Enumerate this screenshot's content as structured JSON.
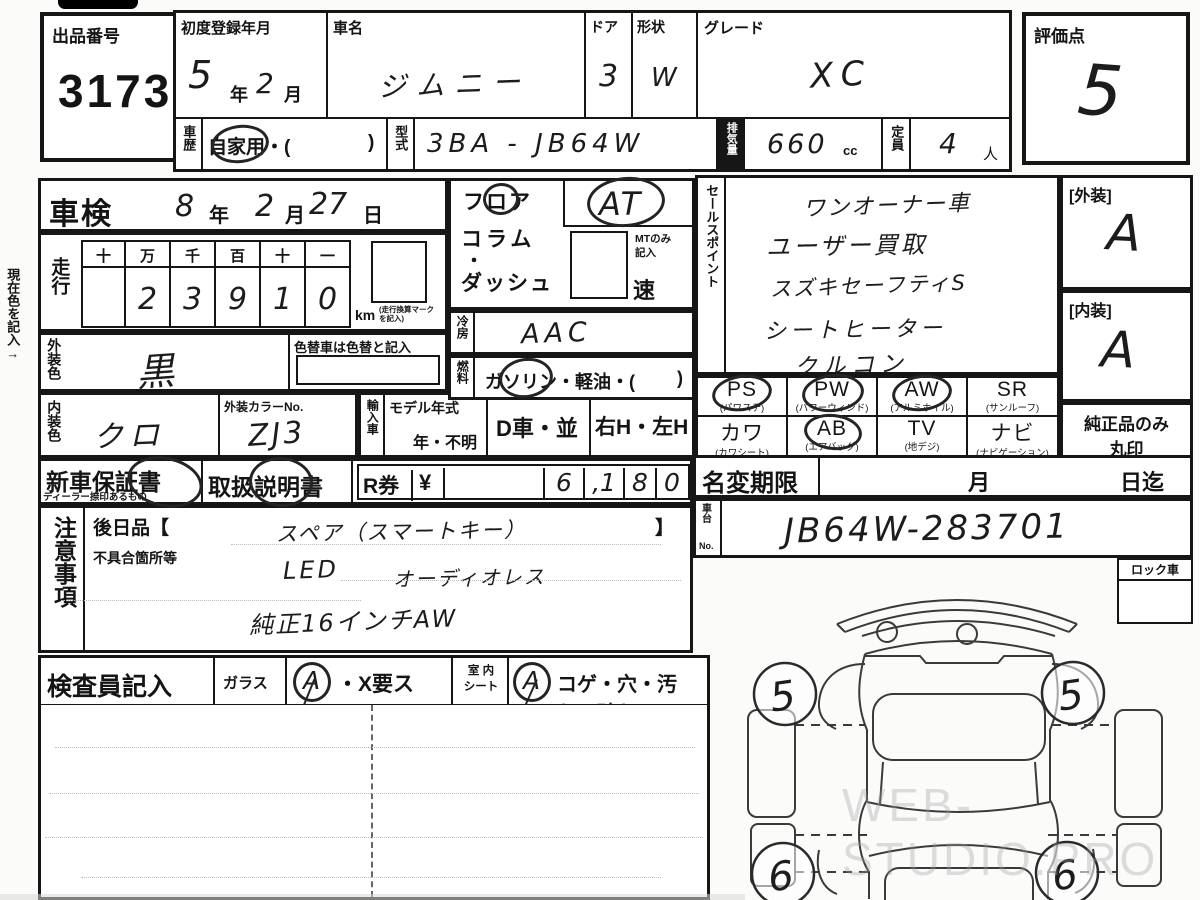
{
  "watermark": "WEB-STUDIO.PRO",
  "margin_note": "現在色を記入→",
  "header": {
    "lot_label": "出品番号",
    "lot_value": "3173",
    "first_reg_label": "初度登録年月",
    "first_reg_year": "5",
    "year_unit": "年",
    "first_reg_month": "2",
    "month_unit": "月",
    "car_name_label": "車名",
    "car_name_value": "ジムニー",
    "door_label": "ドア",
    "door_value": "3",
    "shape_label": "形状",
    "shape_value": "W",
    "grade_label": "グレード",
    "grade_value": "XC",
    "history_label": "車歴",
    "history_value": "自家用・(",
    "history_close": ")",
    "model_code_label": "型式",
    "model_code_value": "3BA - JB64W",
    "displacement_label": "排気量",
    "displacement_value": "660",
    "displacement_unit": "cc",
    "capacity_label": "定員",
    "capacity_value": "4",
    "capacity_unit": "人",
    "score_label": "評価点",
    "score_value": "5"
  },
  "left": {
    "shaken_label": "車検",
    "shaken_year": "8",
    "shaken_month": "2",
    "shaken_day": "27",
    "day_unit": "日",
    "mileage_label": "走行",
    "mileage_headers": [
      "十",
      "万",
      "千",
      "百",
      "十",
      "一"
    ],
    "mileage_digits": [
      "",
      "2",
      "3",
      "9",
      "1",
      "0"
    ],
    "mileage_unit": "km",
    "mileage_note_1": "(走行換算マーク",
    "mileage_note_2": "を記入)",
    "ext_color_label": "外装色",
    "ext_color_value": "黒",
    "color_change_note": "色替車は色替と記入",
    "int_color_label": "内装色",
    "int_color_value": "クロ",
    "color_no_label": "外装カラーNo.",
    "color_no_value": "ZJ3"
  },
  "mid": {
    "floor_line1": "フロア",
    "floor_line2": "コラム",
    "floor_dot": "・",
    "floor_line3": "ダッシュ",
    "at_value": "AT",
    "mt_note_1": "MTのみ",
    "mt_note_2": "記入",
    "speed_label": "速",
    "ac_label": "冷房",
    "ac_value": "AAC",
    "fuel_label": "燃料",
    "fuel_value": "ガソリン・軽油・(",
    "fuel_close": ")",
    "import_label": "輸入車",
    "model_year_label": "モデル年式",
    "model_year_value": "年・不明",
    "dealer_car": "D車・並",
    "handle": "右H・左H"
  },
  "sales": {
    "label": "セールスポイント",
    "lines": [
      "ワンオーナー車",
      "ユーザー買取",
      "スズキセーフティS",
      "シートヒーター",
      "クルコン"
    ]
  },
  "equipment": {
    "items": [
      {
        "code": "PS",
        "name": "(パワステ)",
        "circled": true
      },
      {
        "code": "PW",
        "name": "(パワーウィンド)",
        "circled": true
      },
      {
        "code": "AW",
        "name": "(アルミホイル)",
        "circled": true
      },
      {
        "code": "SR",
        "name": "(サンルーフ)",
        "circled": false
      },
      {
        "code": "カワ",
        "name": "(カワシート)",
        "circled": false
      },
      {
        "code": "AB",
        "name": "(エアバッグ)",
        "circled": true
      },
      {
        "code": "TV",
        "name": "(地デジ)",
        "circled": false
      },
      {
        "code": "ナビ",
        "name": "(ナビゲーション)",
        "circled": false
      }
    ],
    "genuine_line1": "純正品のみ",
    "genuine_line2": "丸印"
  },
  "ratings": {
    "exterior_label": "[外装]",
    "exterior_value": "A",
    "interior_label": "[内装]",
    "interior_value": "A"
  },
  "docs": {
    "warranty_label": "新車保証書",
    "warranty_sub": "ディーラー捺印あるもの",
    "manual_label": "取扱説明書",
    "ticket_label": "R券",
    "yen": "¥",
    "price_cells": [
      "",
      "6",
      ",1",
      "8",
      "0"
    ]
  },
  "transfer": {
    "label": "名変期限",
    "month_unit": "月",
    "due": "日迄"
  },
  "chassis": {
    "label_top": "車台",
    "label_bottom": "No.",
    "value": "JB64W-283701"
  },
  "notes": {
    "label": "注意事項",
    "later_label": "後日品【",
    "later_value": "スペア（スマートキー）",
    "later_close": "】",
    "defect_label": "不具合箇所等",
    "defect_1a": "LED",
    "defect_1b": "オーディオレス",
    "defect_2": "純正16インチAW"
  },
  "inspector": {
    "label": "検査員記入",
    "glass_label": "ガラス",
    "glass_mark": "A",
    "glass_opts": "・X要ス",
    "seat_label_1": "室 内",
    "seat_label_2": "シート",
    "seat_mark": "A",
    "seat_opts": "コゲ・穴・汚れ・破れ"
  },
  "lock": {
    "label": "ロック車"
  },
  "diagram": {
    "front_left": "5",
    "front_right": "5",
    "rear_left": "6",
    "rear_right": "6"
  }
}
